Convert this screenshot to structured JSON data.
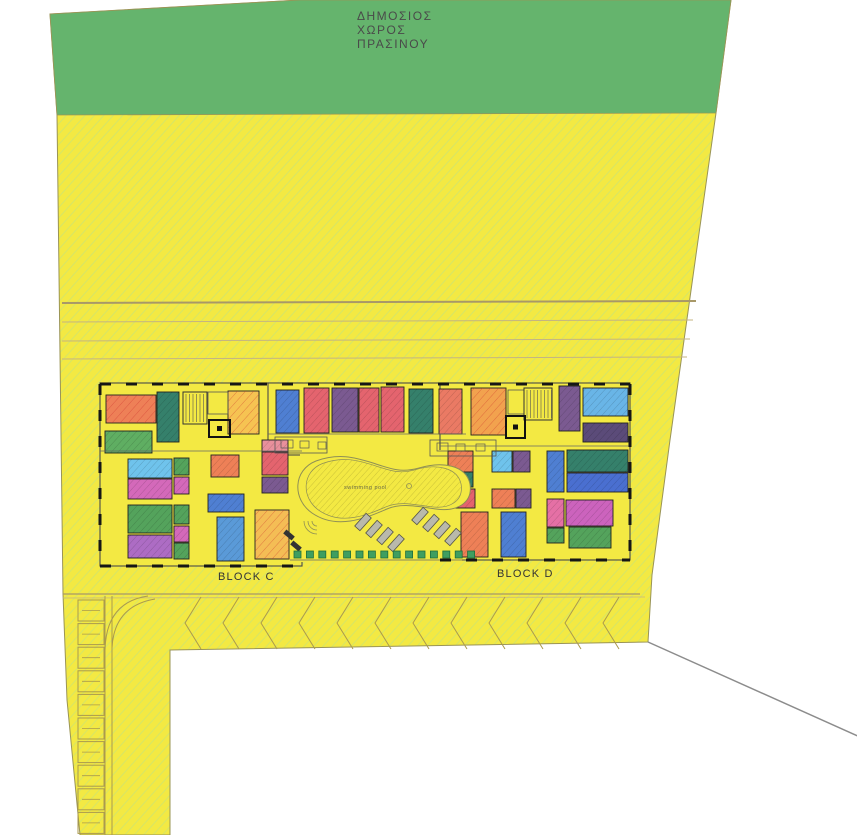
{
  "labels": {
    "green_space": [
      "ΔΗΜΟΣΙΟΣ",
      "ΧΩΡΟΣ",
      "ΠΡΑΣΙΝΟΥ"
    ],
    "block_c": "BLOCK C",
    "block_d": "BLOCK D",
    "swimming_pool": "swimming pool"
  },
  "colors": {
    "background": "#ffffff",
    "site_yellow": "#f3e943",
    "site_hatch_line": "#cfe46f",
    "green_space": "#65b46d",
    "parcel_outline": "#9a9456",
    "wall": "#2a2a2a",
    "wall_dash": "#161616",
    "guide_line_strong": "#a89868",
    "guide_line_faint": "#c4b482",
    "road_line": "#ab9a4d",
    "pool_outline": "#8f8f55",
    "lounger_fill": "#b9b9ab",
    "lounger_stroke": "#55554a",
    "shrub_green": "#3f9e60",
    "shrub_stroke": "#1e6e3c",
    "bench_dark": "#333333",
    "white_edge_line": "#8c8c8c",
    "room_stroke": "#222222",
    "fixture_stroke": "#555555"
  },
  "geometry": {
    "canvas": {
      "w": 857,
      "h": 835
    },
    "site_outline": [
      [
        50,
        14
      ],
      [
        300,
        0
      ],
      [
        731,
        0
      ],
      [
        716,
        113
      ],
      [
        695,
        262
      ],
      [
        670,
        440
      ],
      [
        652,
        575
      ],
      [
        648,
        642
      ],
      [
        170,
        650
      ],
      [
        170,
        835
      ],
      [
        80,
        835
      ],
      [
        67,
        700
      ],
      [
        63,
        594
      ],
      [
        57,
        115
      ]
    ],
    "green_band": [
      [
        50,
        14
      ],
      [
        300,
        0
      ],
      [
        731,
        0
      ],
      [
        716,
        113
      ],
      [
        57,
        115
      ]
    ],
    "guide_lines": [
      [
        62,
        303,
        696,
        301
      ],
      [
        62,
        322,
        693,
        320
      ],
      [
        62,
        341,
        690,
        339
      ],
      [
        62,
        359,
        687,
        357
      ]
    ],
    "white_cut_line": [
      648,
      642,
      860,
      737
    ],
    "blocks": [
      [
        100,
        383,
        202,
        183,
        1
      ],
      [
        268,
        383,
        198,
        72,
        1
      ],
      [
        440,
        383,
        190,
        177,
        1
      ],
      [
        300,
        450,
        162,
        112,
        0
      ]
    ],
    "rooms": [
      [
        106,
        395,
        50,
        28,
        "#ee8057",
        1
      ],
      [
        105,
        431,
        47,
        22,
        "#5fae62",
        0
      ],
      [
        157,
        392,
        22,
        50,
        "#35806b",
        0
      ],
      [
        228,
        391,
        31,
        43,
        "#f6c352",
        1
      ],
      [
        276,
        390,
        23,
        43,
        "#4f7fd2",
        0
      ],
      [
        304,
        388,
        25,
        45,
        "#e4646e",
        0
      ],
      [
        332,
        388,
        26,
        44,
        "#7b5a91",
        0
      ],
      [
        359,
        388,
        20,
        44,
        "#e4646e",
        0
      ],
      [
        381,
        387,
        23,
        45,
        "#e4646e",
        0
      ],
      [
        409,
        389,
        24,
        44,
        "#35806b",
        0
      ],
      [
        439,
        389,
        23,
        45,
        "#ea7a64",
        0
      ],
      [
        471,
        388,
        35,
        47,
        "#f2a24e",
        1
      ],
      [
        559,
        386,
        21,
        45,
        "#7b5a91",
        0
      ],
      [
        583,
        388,
        45,
        28,
        "#69b5e7",
        0
      ],
      [
        583,
        423,
        45,
        19,
        "#5b4b79",
        0
      ],
      [
        128,
        459,
        44,
        19,
        "#6fc3ec",
        0
      ],
      [
        128,
        479,
        44,
        20,
        "#d469ba",
        0
      ],
      [
        128,
        505,
        44,
        28,
        "#54a35c",
        0
      ],
      [
        128,
        535,
        44,
        23,
        "#ad6cc4",
        0
      ],
      [
        174,
        458,
        15,
        17,
        "#54a35c",
        0
      ],
      [
        174,
        477,
        15,
        17,
        "#d469ba",
        0
      ],
      [
        174,
        505,
        15,
        19,
        "#54a35c",
        0
      ],
      [
        174,
        526,
        15,
        16,
        "#d469ba",
        0
      ],
      [
        174,
        543,
        15,
        16,
        "#54a35c",
        0
      ],
      [
        211,
        455,
        28,
        22,
        "#ee8057",
        0
      ],
      [
        208,
        494,
        36,
        18,
        "#4f7fd2",
        0
      ],
      [
        217,
        517,
        27,
        44,
        "#5a9ad8",
        0
      ],
      [
        262,
        440,
        26,
        12,
        "#e8909c",
        0
      ],
      [
        262,
        452,
        26,
        23,
        "#e4646e",
        0
      ],
      [
        262,
        477,
        26,
        16,
        "#7b5a91",
        0
      ],
      [
        255,
        510,
        34,
        49,
        "#f4bd55",
        1
      ],
      [
        448,
        451,
        25,
        21,
        "#ee8057",
        0
      ],
      [
        448,
        472,
        25,
        15,
        "#35806b",
        0
      ],
      [
        448,
        489,
        27,
        19,
        "#e4646e",
        0
      ],
      [
        492,
        451,
        20,
        21,
        "#6fc3ec",
        0
      ],
      [
        513,
        451,
        17,
        21,
        "#7b5a91",
        0
      ],
      [
        492,
        489,
        23,
        19,
        "#ee8057",
        0
      ],
      [
        516,
        489,
        15,
        19,
        "#7b5a91",
        0
      ],
      [
        461,
        512,
        27,
        45,
        "#ee8057",
        0
      ],
      [
        501,
        512,
        25,
        45,
        "#4f7fd2",
        0
      ],
      [
        547,
        451,
        17,
        41,
        "#4f7fd2",
        0
      ],
      [
        567,
        450,
        61,
        22,
        "#35806b",
        0
      ],
      [
        567,
        473,
        61,
        19,
        "#4a6fd0",
        0
      ],
      [
        547,
        499,
        17,
        28,
        "#e570a5",
        0
      ],
      [
        566,
        500,
        47,
        26,
        "#cc63bd",
        0
      ],
      [
        547,
        528,
        17,
        15,
        "#54a35c",
        0
      ],
      [
        569,
        527,
        42,
        21,
        "#54a35c",
        0
      ]
    ],
    "outline_rects": [
      [
        208,
        392,
        20,
        22
      ],
      [
        508,
        390,
        16,
        24
      ],
      [
        275,
        437,
        52,
        16
      ],
      [
        430,
        440,
        66,
        16
      ]
    ],
    "fixtures": [
      [
        281,
        440,
        12,
        8
      ],
      [
        300,
        441,
        9,
        7
      ],
      [
        318,
        442,
        8,
        7
      ],
      [
        437,
        443,
        11,
        8
      ],
      [
        456,
        444,
        9,
        7
      ],
      [
        476,
        444,
        9,
        7
      ]
    ],
    "stairs": [
      [
        183,
        392,
        24,
        32
      ],
      [
        524,
        388,
        28,
        32
      ]
    ],
    "lifts": [
      [
        209,
        420,
        21,
        17
      ],
      [
        506,
        416,
        19,
        22
      ]
    ],
    "thin_lines": [
      [
        268,
        434,
        466,
        434
      ],
      [
        100,
        451,
        302,
        451
      ],
      [
        440,
        446,
        630,
        446
      ],
      [
        290,
        560,
        470,
        560
      ]
    ],
    "wall_dashes": [
      "M100,384 H630",
      "M100,384 V566",
      "M100,566 H302",
      "M440,560 H630",
      "M630,384 V560"
    ],
    "pool": {
      "outer": "M 312,513 C 292,499 293,470 316,461 C 338,453 354,457 373,463 C 391,469 401,473 419,468 C 442,461 466,465 470,484 C 473,503 457,512 436,509 C 415,506 401,503 387,509 C 368,517 338,531 312,513 Z",
      "center": [
        381,
        486
      ],
      "inner_scale": 0.9,
      "drain": [
        409,
        486,
        2.5
      ],
      "steps_center": [
        317,
        521
      ],
      "steps_radii": [
        5,
        9,
        13
      ]
    },
    "benches": [
      [
        289,
        535
      ],
      [
        296,
        546
      ]
    ],
    "loungers": {
      "points": [
        [
          363,
          522
        ],
        [
          374,
          529
        ],
        [
          385,
          536
        ],
        [
          396,
          543
        ],
        [
          420,
          516
        ],
        [
          431,
          523
        ],
        [
          442,
          530
        ],
        [
          453,
          537
        ]
      ],
      "w": 7,
      "h": 17,
      "angle": 42
    },
    "shrubs": {
      "x0": 294,
      "y": 551,
      "count": 15,
      "step": 12.4,
      "size": 7
    },
    "parking": {
      "row_top": [
        63,
        594,
        640,
        594
      ],
      "row_top2": [
        63,
        598,
        645,
        597
      ],
      "chevrons": {
        "x0": 185,
        "count": 12,
        "step": 38,
        "y_top": 597,
        "y_mid": 623,
        "y_bot": 649,
        "depth": 16
      },
      "road_vlines": [
        [
          105,
          596,
          105,
          835
        ],
        [
          112,
          596,
          112,
          835
        ]
      ],
      "curves": [
        "M 112,648 Q 114,606 155,599",
        "M 105,650 Q 106,602 148,596"
      ],
      "stalls": {
        "x": 78,
        "w": 26,
        "h": 21,
        "y0": 600,
        "count": 10,
        "step": 23.6
      }
    }
  }
}
